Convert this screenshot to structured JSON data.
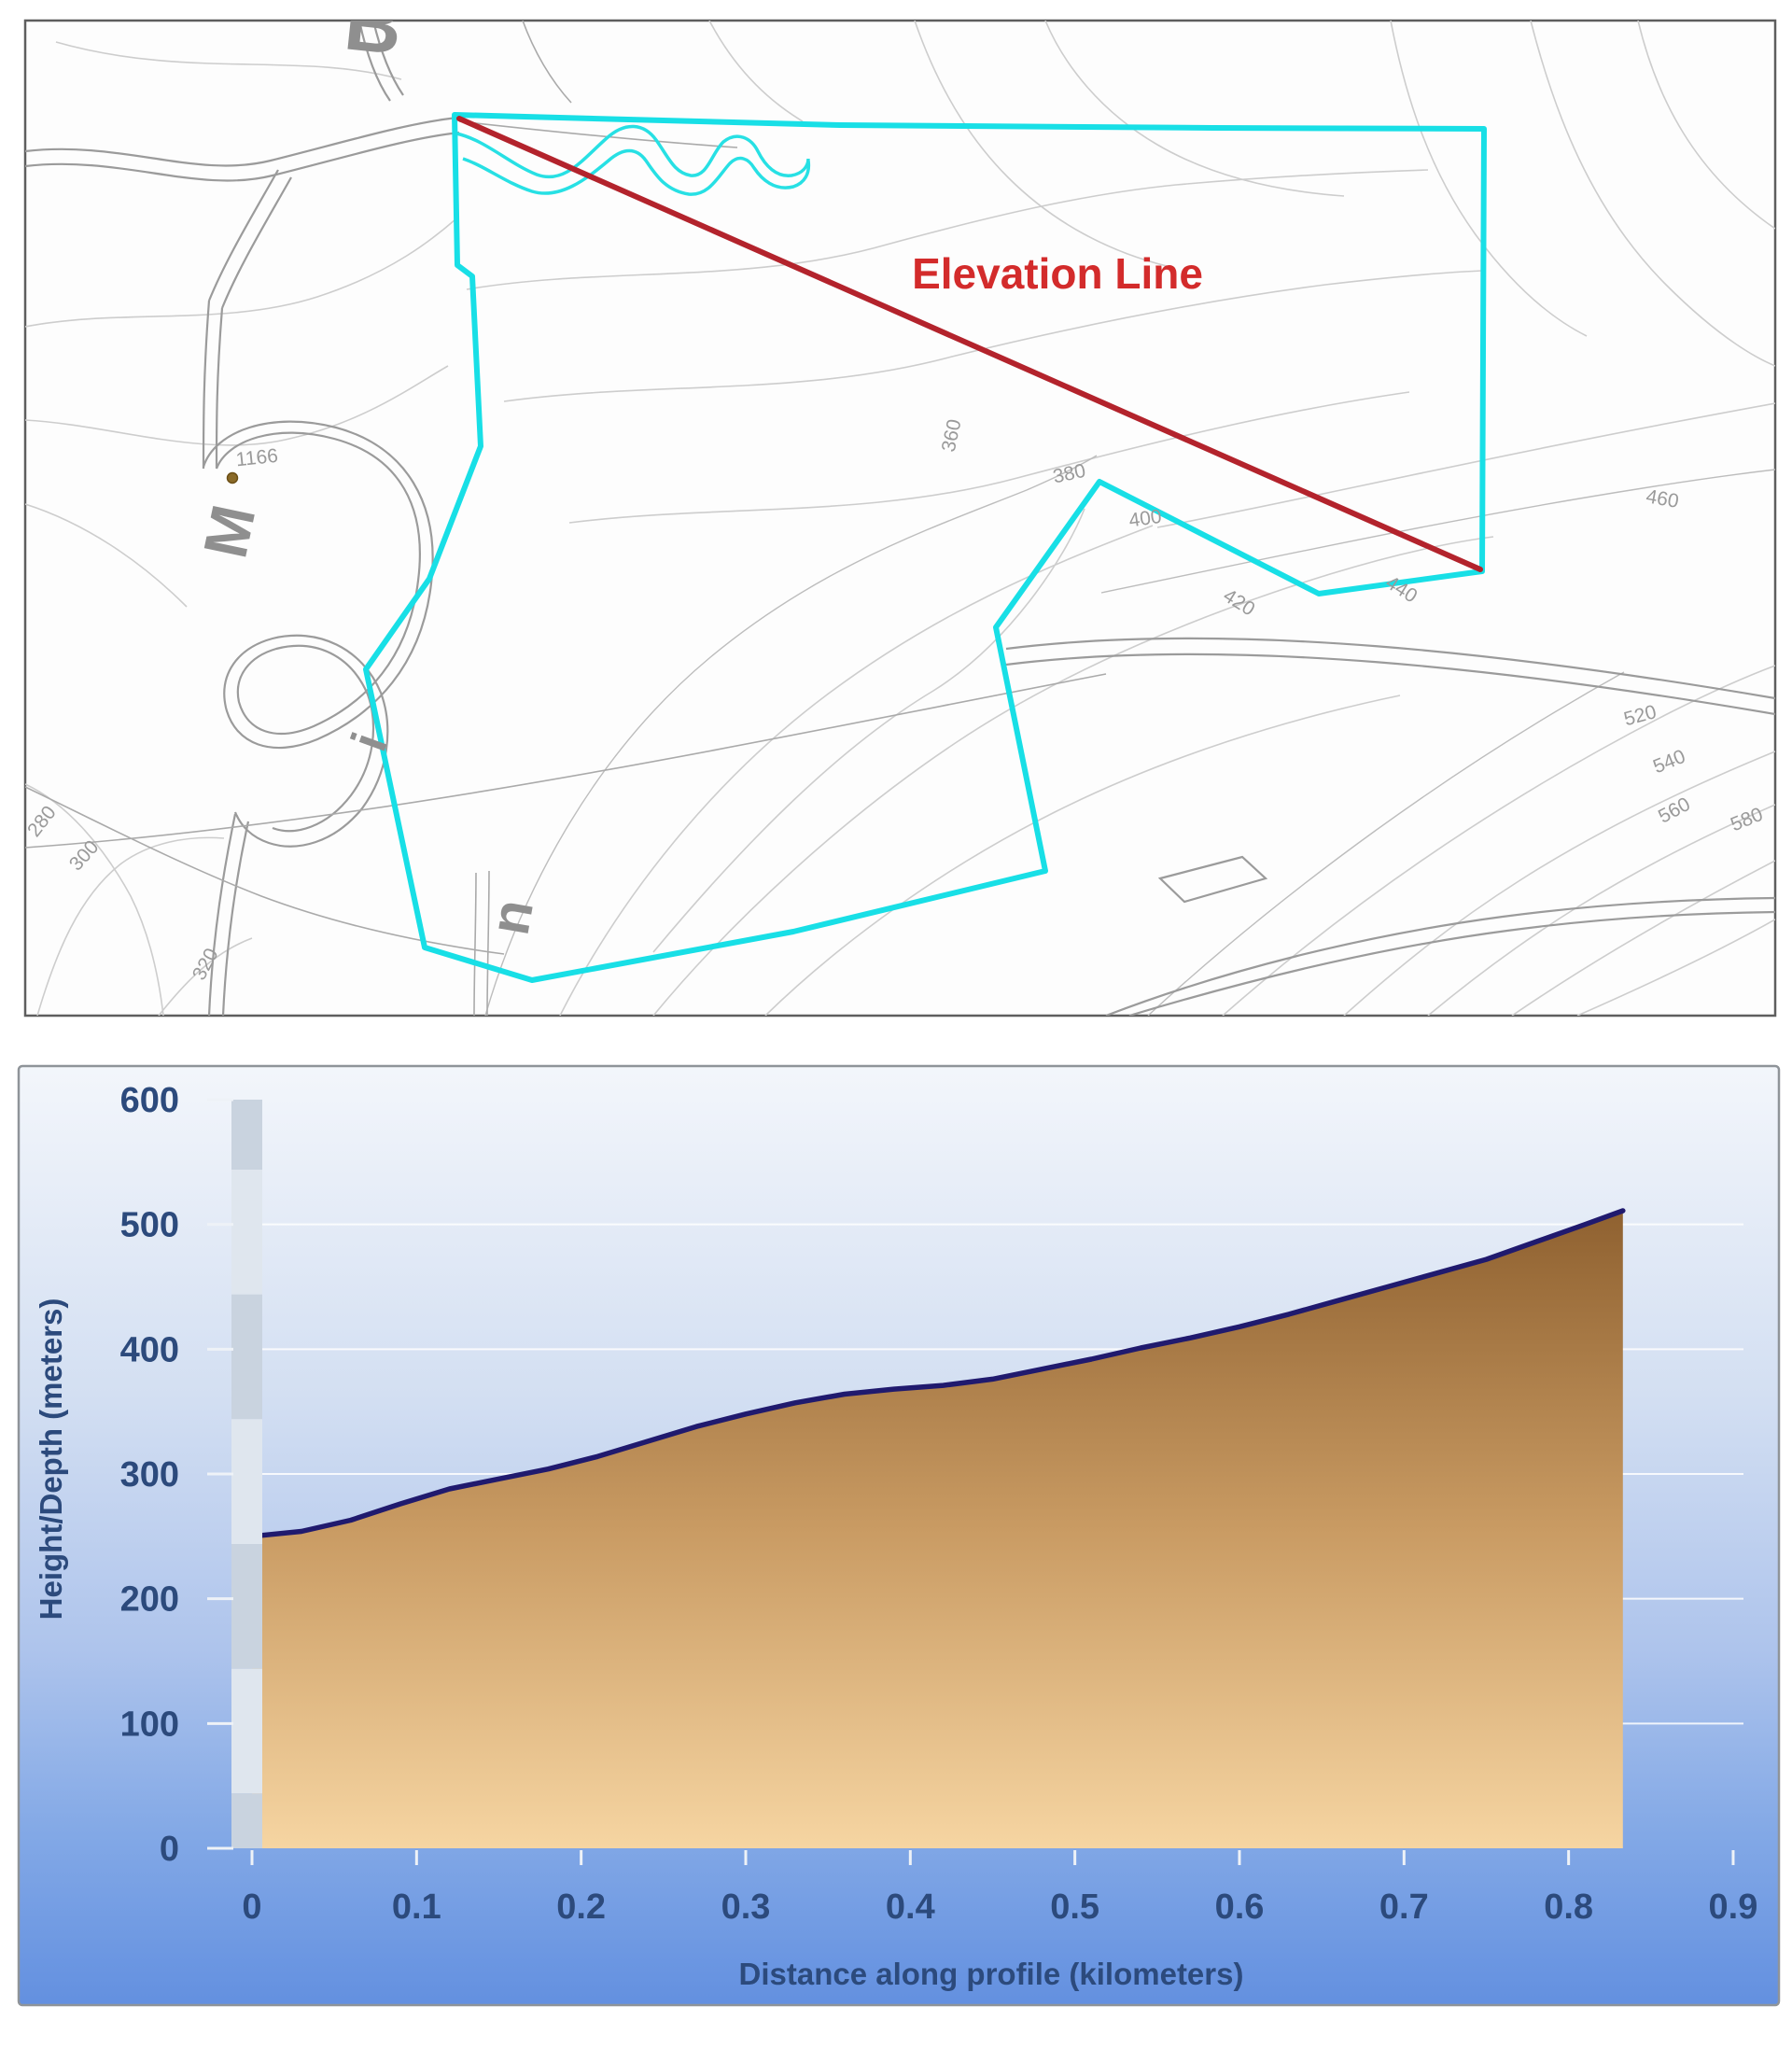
{
  "map": {
    "elevation_line_label": {
      "text": "Elevation Line",
      "x": 1133,
      "y": 309,
      "color": "#d32b2b"
    },
    "elevation_line": {
      "x1": 492,
      "y1": 127,
      "x2": 1586,
      "y2": 610,
      "color": "#b3232c"
    },
    "parcel_outline": {
      "color": "#18dfe6",
      "points": [
        [
          487,
          123
        ],
        [
          900,
          134
        ],
        [
          1300,
          137
        ],
        [
          1590,
          138
        ],
        [
          1588,
          612
        ],
        [
          1413,
          636
        ],
        [
          1178,
          516
        ],
        [
          1067,
          672
        ],
        [
          1120,
          933
        ],
        [
          850,
          998
        ],
        [
          570,
          1050
        ],
        [
          455,
          1015
        ],
        [
          392,
          717
        ],
        [
          460,
          620
        ],
        [
          515,
          478
        ],
        [
          506,
          296
        ],
        [
          490,
          284
        ]
      ]
    },
    "stream_color": "#27e0e4",
    "spot_height": {
      "text": "1166",
      "x": 276,
      "y": 497,
      "dot_x": 249,
      "dot_y": 512
    },
    "place_letters": [
      {
        "text": "B",
        "x": 397,
        "y": 55,
        "rot": 6,
        "size": 84
      },
      {
        "text": "M",
        "x": 268,
        "y": 574,
        "rot": -78,
        "size": 66
      },
      {
        "text": "i",
        "x": 413,
        "y": 801,
        "rot": -70,
        "size": 54
      },
      {
        "text": "n",
        "x": 568,
        "y": 986,
        "rot": -80,
        "size": 60
      }
    ],
    "contour_labels": [
      {
        "text": "280",
        "x": 50,
        "y": 884,
        "rot": -52
      },
      {
        "text": "300",
        "x": 95,
        "y": 921,
        "rot": -48
      },
      {
        "text": "320",
        "x": 226,
        "y": 1036,
        "rot": -62
      },
      {
        "text": "360",
        "x": 1026,
        "y": 468,
        "rot": -78
      },
      {
        "text": "380",
        "x": 1147,
        "y": 514,
        "rot": -12
      },
      {
        "text": "400",
        "x": 1228,
        "y": 562,
        "rot": -8
      },
      {
        "text": "420",
        "x": 1324,
        "y": 651,
        "rot": 32
      },
      {
        "text": "440",
        "x": 1498,
        "y": 637,
        "rot": 32
      },
      {
        "text": "460",
        "x": 1780,
        "y": 541,
        "rot": 10
      },
      {
        "text": "520",
        "x": 1759,
        "y": 773,
        "rot": -15
      },
      {
        "text": "540",
        "x": 1791,
        "y": 822,
        "rot": -22
      },
      {
        "text": "560",
        "x": 1797,
        "y": 874,
        "rot": -28
      },
      {
        "text": "580",
        "x": 1874,
        "y": 884,
        "rot": -22
      }
    ]
  },
  "chart_data": {
    "type": "area",
    "title": "",
    "xlabel": "Distance along profile (kilometers)",
    "ylabel": "Height/Depth (meters)",
    "xlim": [
      0,
      0.93
    ],
    "ylim": [
      0,
      600
    ],
    "grid": true,
    "x_ticks": [
      {
        "v": 0.0,
        "label": "0"
      },
      {
        "v": 0.1,
        "label": "0.1"
      },
      {
        "v": 0.2,
        "label": "0.2"
      },
      {
        "v": 0.3,
        "label": "0.3"
      },
      {
        "v": 0.4,
        "label": "0.4"
      },
      {
        "v": 0.5,
        "label": "0.5"
      },
      {
        "v": 0.6,
        "label": "0.6"
      },
      {
        "v": 0.7,
        "label": "0.7"
      },
      {
        "v": 0.8,
        "label": "0.8"
      },
      {
        "v": 0.9,
        "label": "0.9"
      }
    ],
    "y_ticks": [
      {
        "v": 0,
        "label": "0"
      },
      {
        "v": 100,
        "label": "100"
      },
      {
        "v": 200,
        "label": "200"
      },
      {
        "v": 300,
        "label": "300"
      },
      {
        "v": 400,
        "label": "400"
      },
      {
        "v": 500,
        "label": "500"
      },
      {
        "v": 600,
        "label": "600"
      }
    ],
    "series": [
      {
        "name": "elevation-profile",
        "points": [
          [
            0,
            250
          ],
          [
            0.03,
            254
          ],
          [
            0.06,
            263
          ],
          [
            0.09,
            276
          ],
          [
            0.12,
            288
          ],
          [
            0.15,
            296
          ],
          [
            0.18,
            304
          ],
          [
            0.21,
            314
          ],
          [
            0.24,
            326
          ],
          [
            0.27,
            338
          ],
          [
            0.3,
            348
          ],
          [
            0.33,
            357
          ],
          [
            0.36,
            364
          ],
          [
            0.39,
            368
          ],
          [
            0.42,
            371
          ],
          [
            0.45,
            376
          ],
          [
            0.48,
            384
          ],
          [
            0.51,
            392
          ],
          [
            0.54,
            401
          ],
          [
            0.57,
            409
          ],
          [
            0.6,
            418
          ],
          [
            0.63,
            428
          ],
          [
            0.66,
            439
          ],
          [
            0.69,
            450
          ],
          [
            0.72,
            461
          ],
          [
            0.75,
            472
          ],
          [
            0.78,
            486
          ],
          [
            0.81,
            500
          ],
          [
            0.833,
            511
          ]
        ]
      }
    ],
    "colors": {
      "curve": "#201a6e",
      "fill_top": "#8f6130",
      "fill_mid": "#c99b63",
      "fill_bottom": "#f6d5a2",
      "label": "#2c4a7c",
      "grid": "#ffffff",
      "bar_dark": "#c9d3df",
      "bar_light": "#dfe6ee"
    }
  }
}
